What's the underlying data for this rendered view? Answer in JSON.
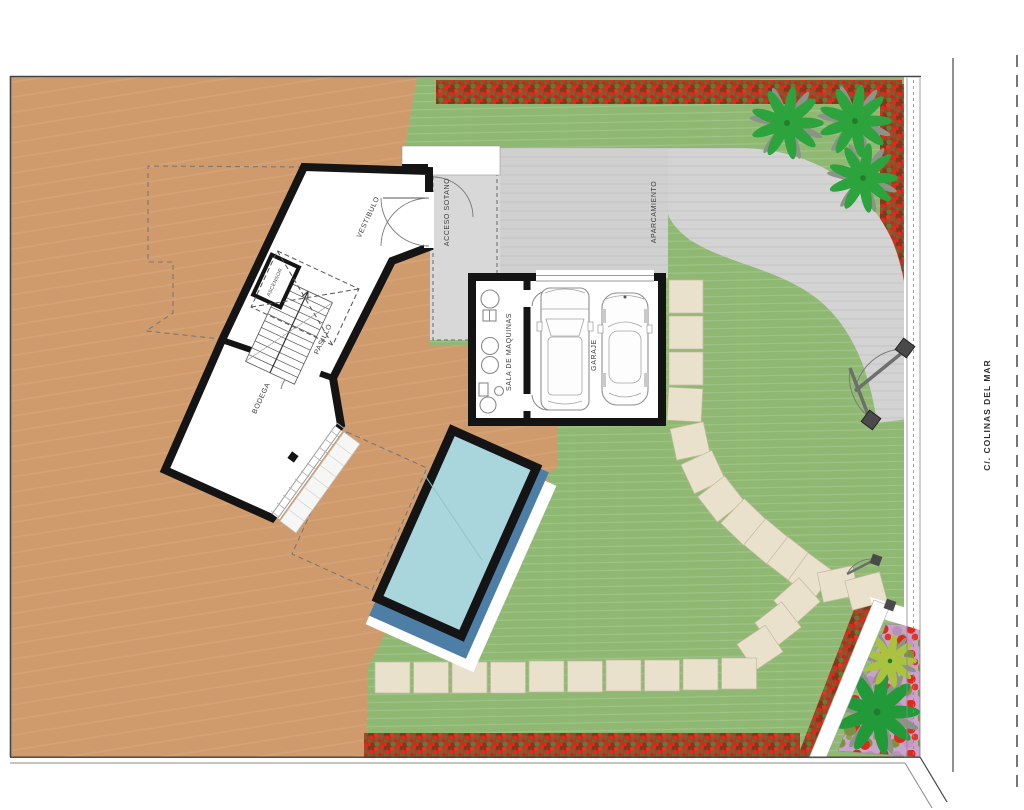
{
  "plan": {
    "labels": {
      "vestibulo": "VESTIBULO",
      "acceso_sotano": "ACCESO SOTANO",
      "aparcamiento": "APARCAMIENTO",
      "pasillo": "PASILLO",
      "ascensor": "ASCENSOR",
      "bodega": "BODEGA",
      "sala_de_maquinas": "SALA DE MAQUINAS",
      "garaje": "GARAJE",
      "street": "C/. COLINAS DEL MAR"
    },
    "colors": {
      "terrain": "#d09b6c",
      "lawn": "#8fb973",
      "driveway": "#d3d3d3",
      "ramp": "#d8d8d8",
      "parking": "#d0d0d0",
      "pool_water": "#a9d6dd",
      "pool_shadow": "#4d7ea6",
      "wall": "#141414",
      "hedge_base": "#8a4a28",
      "flower_red": "#e8251a",
      "palm_green": "#2ca33c",
      "garden_purple": "#c9a3cb",
      "stone": "#eae1cc"
    }
  }
}
